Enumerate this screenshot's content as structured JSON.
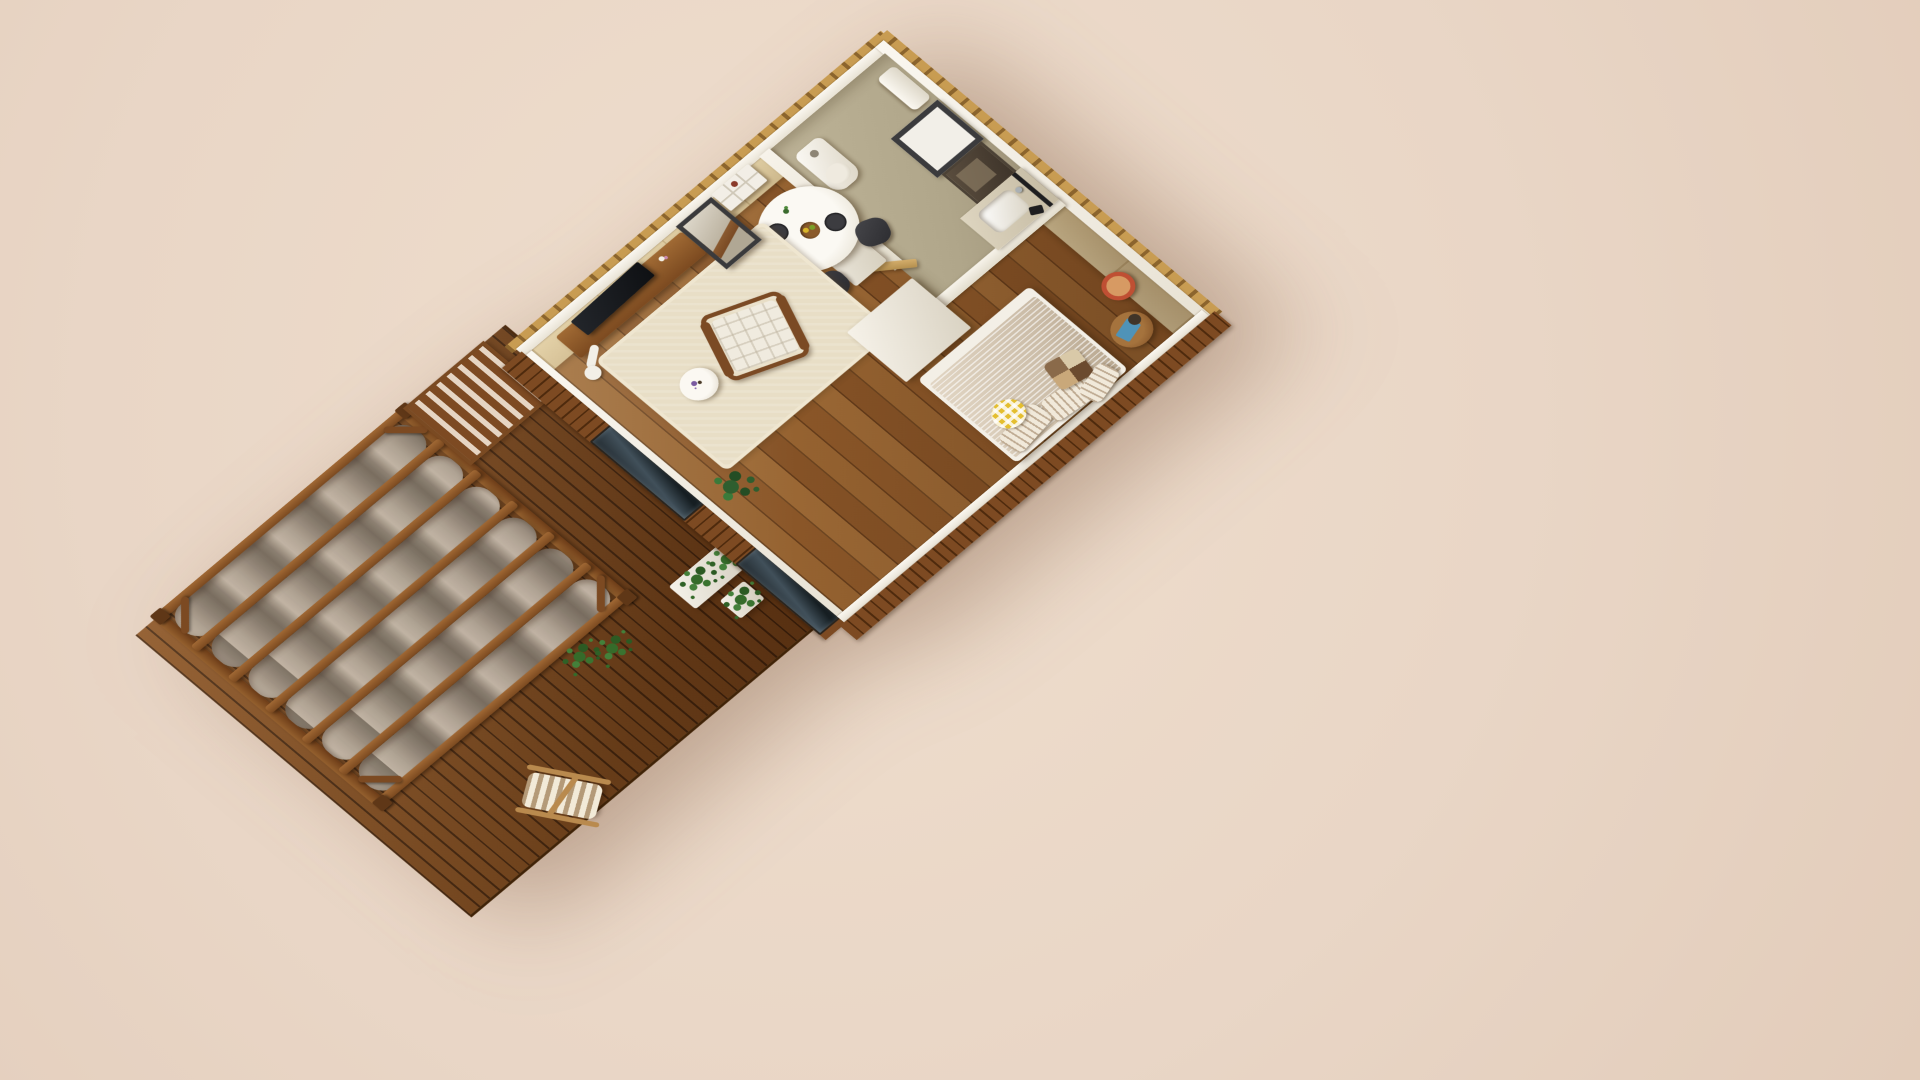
{
  "scene": {
    "type": "isometric-3d-render",
    "subject": "Cutaway dollhouse view of a tiny house interior with attached wood deck and canvas-shade pergola",
    "view": "top-down oblique, plan rotated 45 degrees",
    "background_color": "#e9d6c6",
    "visible_text": "none"
  },
  "labels": {
    "scene": "Tiny house isometric render",
    "house": "Tiny house interior (cutaway walls with white caps)",
    "deck": "Diagonal wood plank deck",
    "pergola": "Wood pergola with wavy canvas shade strips",
    "lattice": "Slatted wood lattice section",
    "living_room": "Living room",
    "dining_area": "Dining area",
    "kitchenette": "Kitchenette",
    "bathroom": "Bathroom",
    "bedroom": "Bedroom",
    "bed": "Double bed with pinstriped duvet",
    "sling_chair": "Striped folding sling chair",
    "planter": "White planter with ferns",
    "glass_door_living": "Living room glass door",
    "glass_door_bedroom": "Bedroom glass door",
    "ac_unit": "Wall air-conditioner",
    "wardrobe": "White wardrobe volume",
    "toilet": "Toilet",
    "vanity_mirror": "Bathroom mirror",
    "wall_niche": "Recessed wall niche",
    "wash_basin": "Wash basin",
    "shower": "Black shower set",
    "dining_table": "Round white dining table",
    "tv_console": "Wood TV console",
    "armchair": "Wood-frame armchair",
    "rug": "Cream area rug",
    "leaning_mirror": "Tall leaning mirror",
    "wall_shelf": "White wall shelf",
    "stool_table": "Round wood stool side table",
    "red_lamp": "Red bedside lamp",
    "monstera": "Monstera plant"
  },
  "palette": {
    "backdrop": "#e9d6c6",
    "deck_wood": "#7c4a22",
    "deck_gap": "#3f2410",
    "floor_wood": "#8f5c2c",
    "wall_cap_white": "#f6f2e9",
    "interior_wall_tan": "#d5c39a",
    "osb_band": "#c89c52",
    "cladding_wood": "#7d4a22",
    "bathroom_wall": "#b4aa8f",
    "canvas_fabric": "#a79a8b",
    "rug_cream": "#e8dec6",
    "sink_blue": "#2b5ca8",
    "lamp_red": "#bf4f33",
    "pillow_yellow": "#e4be2f",
    "plant_green": "#356b2a",
    "chair_dark": "#3a3a3e",
    "frame_dark": "#3b3b3d",
    "glass_dark": "#2a343a"
  },
  "house": {
    "rooms": [
      {
        "name": "living-room",
        "items": [
          "tv-console",
          "tv",
          "floor-lamp",
          "leaning-mirror",
          "wall-shelf",
          "rug",
          "armchair",
          "round-side-table",
          "flower-vase",
          "monstera-plant"
        ]
      },
      {
        "name": "dining-area",
        "items": [
          "round-dining-table",
          "dining-chairs",
          "dinner-plates",
          "fruit-bowl",
          "table-plant"
        ]
      },
      {
        "name": "kitchenette",
        "items": [
          "white-counter",
          "blue-sink",
          "dark-basin",
          "faucet"
        ]
      },
      {
        "name": "bathroom",
        "items": [
          "toilet",
          "vanity-mirror",
          "wall-niche",
          "vanity-counter",
          "wash-basin",
          "shower-set",
          "toilet-paper-holder",
          "swing-door"
        ]
      },
      {
        "name": "bedroom",
        "items": [
          "double-bed",
          "pinstripe-duvet",
          "striped-pillows",
          "yellow-gingham-pillow",
          "patchwork-pillow",
          "round-stool-side-table",
          "blue-book",
          "dark-bowl",
          "red-bedside-lamp",
          "wardrobe-volume"
        ]
      }
    ],
    "shell_features": [
      "white-wall-caps",
      "osb-top-bands-with-notches",
      "tan-interior-wall-faces",
      "vertical-wood-slat-cladding",
      "glass-door-living",
      "glass-door-bedroom",
      "air-conditioner",
      "diagonal-wood-floor-planks"
    ]
  },
  "deck": {
    "items": [
      "diagonal-decking-boards",
      "pergola-frame",
      "pergola-posts",
      "corner-braces",
      "rafters",
      "canvas-shade-strips",
      "slatted-lattice",
      "striped-sling-chair",
      "long-white-planter",
      "small-fern-pot",
      "edge-ferns"
    ]
  },
  "counts": {
    "pergola_rafters": 7,
    "canvas_strips": 6,
    "dining_chairs": 3,
    "dinner_plates": 2,
    "bed_pillows": 5,
    "glass_doors": 2,
    "planters": 2
  }
}
